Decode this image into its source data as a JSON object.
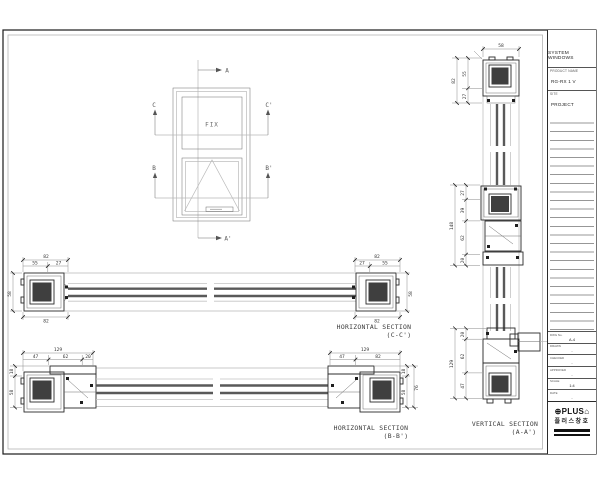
{
  "title_block": {
    "system": "SYSTEM WINDOWS",
    "product_label": "PRODUCT NAME",
    "product_value": "RG-RX 1 V",
    "site_label": "SITE",
    "site_value": "PROJECT",
    "fields": [
      {
        "label": "DWG No.",
        "value": "A-4"
      },
      {
        "label": "DRAWN",
        "value": "-"
      },
      {
        "label": "CHECKED",
        "value": "-"
      },
      {
        "label": "APPROVED",
        "value": "-"
      },
      {
        "label": "SCALE",
        "value": "1:4"
      },
      {
        "label": "DATE",
        "value": "-"
      }
    ],
    "logo_prefix": "⊕",
    "logo_text": "PLUS",
    "logo_suffix": "⌂",
    "logo_korean": "플러스창호"
  },
  "elevation": {
    "fix": "FIX",
    "a": "A",
    "a_prime": "A'",
    "b": "B",
    "b_prime": "B'",
    "c": "C",
    "c_prime": "C'"
  },
  "sections": {
    "cc": {
      "title": "HORIZONTAL SECTION",
      "subtitle": "(C-C')",
      "dims": {
        "top_left_total": "82",
        "top_left_a": "55",
        "top_left_b": "27",
        "left_height": "58",
        "bottom_left": "82",
        "top_right_total": "82",
        "top_right_a": "27",
        "top_right_b": "55",
        "right_height": "58",
        "bottom_right": "82"
      }
    },
    "bb": {
      "title": "HORIZONTAL SECTION",
      "subtitle": "(B-B')",
      "dims": {
        "top_left_total": "129",
        "top_left_a": "47",
        "top_left_b": "62",
        "top_left_c": "20",
        "left_h1": "18",
        "left_h2": "58",
        "top_right_total": "129",
        "top_right_a": "47",
        "top_right_b": "82",
        "right_h1": "18",
        "right_h2": "58",
        "right_total": "76"
      }
    },
    "aa": {
      "title": "VERTICAL SECTION",
      "subtitle": "(A-A')",
      "dims": {
        "top_width": "58",
        "head_a": "55",
        "head_b": "27",
        "head_total": "82",
        "mid_a": "27",
        "mid_b": "39",
        "mid_c": "62",
        "mid_d": "20",
        "mid_total": "148",
        "bot_a": "20",
        "bot_b": "62",
        "bot_c": "47",
        "bot_total": "129"
      }
    }
  }
}
